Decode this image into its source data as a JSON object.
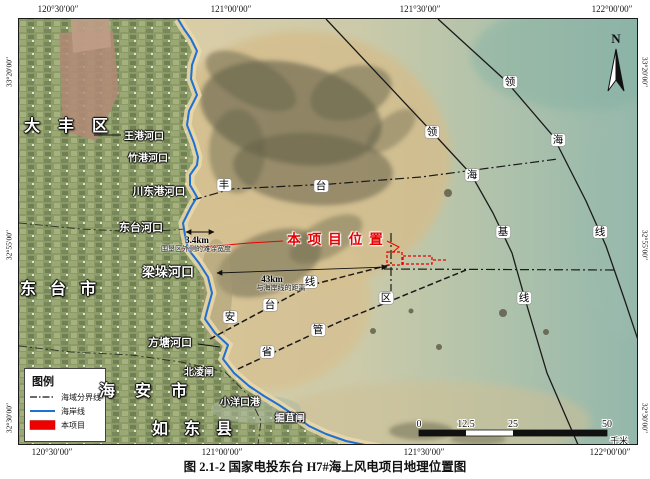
{
  "caption": "图 2.1-2   国家电投东台 H7#海上风电项目地理位置图",
  "compass": {
    "label": "N"
  },
  "grid": {
    "top": [
      {
        "text": "120°30′00″",
        "x": 58
      },
      {
        "text": "121°00′00″",
        "x": 231
      },
      {
        "text": "121°30′00″",
        "x": 420
      },
      {
        "text": "122°00′00″",
        "x": 612
      }
    ],
    "bottom": [
      {
        "text": "120°30′00″",
        "x": 52
      },
      {
        "text": "121°00′00″",
        "x": 222
      },
      {
        "text": "121°30′00″",
        "x": 424
      },
      {
        "text": "122°00′00″",
        "x": 610
      }
    ],
    "left": [
      {
        "text": "33°20′00″",
        "y": 72
      },
      {
        "text": "32°55′00″",
        "y": 245
      },
      {
        "text": "32°30′00″",
        "y": 418
      }
    ],
    "right": [
      {
        "text": "33°20′00″",
        "y": 72
      },
      {
        "text": "32°55′00″",
        "y": 245
      },
      {
        "text": "32°30′00″",
        "y": 418
      }
    ]
  },
  "regions": [
    {
      "text": "大丰区",
      "x": 66,
      "y": 124,
      "ls": 18
    },
    {
      "text": "东台市",
      "x": 58,
      "y": 287,
      "ls": 14
    },
    {
      "text": "海安市",
      "x": 143,
      "y": 389,
      "ls": 20
    },
    {
      "text": "如东县",
      "x": 192,
      "y": 427,
      "ls": 16
    }
  ],
  "coast_labels": [
    {
      "text": "王港河口",
      "x": 144,
      "y": 135,
      "size": 10
    },
    {
      "text": "竹港河口",
      "x": 148,
      "y": 157,
      "size": 10
    },
    {
      "text": "川东港河口",
      "x": 159,
      "y": 191,
      "size": 10.5
    },
    {
      "text": "东台河口",
      "x": 141,
      "y": 227,
      "size": 11
    },
    {
      "text": "梁垛河口",
      "x": 168,
      "y": 271,
      "size": 13
    },
    {
      "text": "方塘河口",
      "x": 170,
      "y": 342,
      "size": 11
    },
    {
      "text": "北凌闸",
      "x": 199,
      "y": 371,
      "size": 10
    },
    {
      "text": "小洋口港",
      "x": 240,
      "y": 401,
      "size": 10
    },
    {
      "text": "掘苴闸",
      "x": 290,
      "y": 417,
      "size": 10
    }
  ],
  "boundary_chars": [
    {
      "text": "丰",
      "x": 224,
      "y": 185
    },
    {
      "text": "台",
      "x": 321,
      "y": 186
    },
    {
      "text": "安",
      "x": 230,
      "y": 317
    },
    {
      "text": "台",
      "x": 270,
      "y": 305
    },
    {
      "text": "线",
      "x": 310,
      "y": 282
    },
    {
      "text": "省",
      "x": 267,
      "y": 352
    },
    {
      "text": "管",
      "x": 318,
      "y": 330
    },
    {
      "text": "区",
      "x": 386,
      "y": 298
    },
    {
      "text": "领",
      "x": 432,
      "y": 132
    },
    {
      "text": "海",
      "x": 472,
      "y": 175
    },
    {
      "text": "基",
      "x": 503,
      "y": 232
    },
    {
      "text": "线",
      "x": 524,
      "y": 298
    },
    {
      "text": "领",
      "x": 510,
      "y": 82
    },
    {
      "text": "海",
      "x": 558,
      "y": 140
    },
    {
      "text": "线",
      "x": 600,
      "y": 232
    }
  ],
  "project": {
    "label": "本项目位置",
    "x": 335,
    "y": 238,
    "color": "#e60000"
  },
  "distances": [
    {
      "km": "3.4km",
      "desc": "围垦区外侧的滩涂宽度",
      "kx": 197,
      "ky": 240,
      "dx": 196,
      "dy": 249
    },
    {
      "km": "43km",
      "desc": "与海岸线的距离",
      "kx": 272,
      "ky": 279,
      "dx": 281,
      "dy": 288
    }
  ],
  "legend": {
    "title": "图例",
    "items": [
      {
        "label": "海域分界线",
        "type": "dashdot"
      },
      {
        "label": "海岸线",
        "type": "coast"
      },
      {
        "label": "本项目",
        "type": "project"
      }
    ]
  },
  "scalebar": {
    "ticks": [
      "0",
      "12.5",
      "25",
      "50"
    ],
    "unit": "千米"
  },
  "colors": {
    "coastline": "#1f6fd4",
    "project_red": "#ee0000",
    "boundary": "#1a1a1a"
  }
}
